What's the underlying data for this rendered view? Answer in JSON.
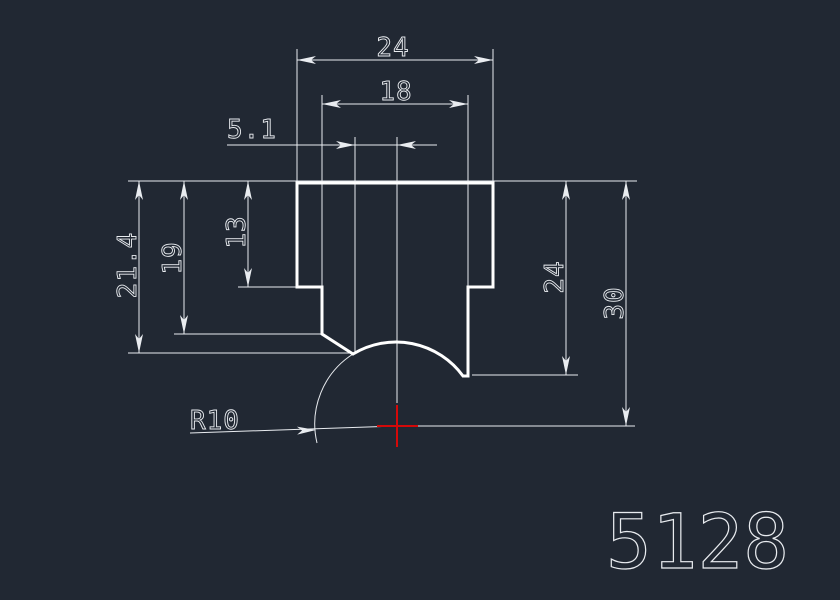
{
  "viewport": {
    "background": "#212833",
    "description": "CAD drawing viewport"
  },
  "colors": {
    "part_outline": "#ffffff",
    "dimension": "#e9ecf0",
    "center_mark": "#d40909"
  },
  "drawing_number": "5128",
  "dimensions": {
    "top_width": "24",
    "inner_width": "18",
    "offset": "5.1",
    "depth_total": "21.4",
    "depth_mid": "19",
    "depth_step": "13",
    "depth_right": "24",
    "depth_center": "30",
    "radius": "R10"
  }
}
